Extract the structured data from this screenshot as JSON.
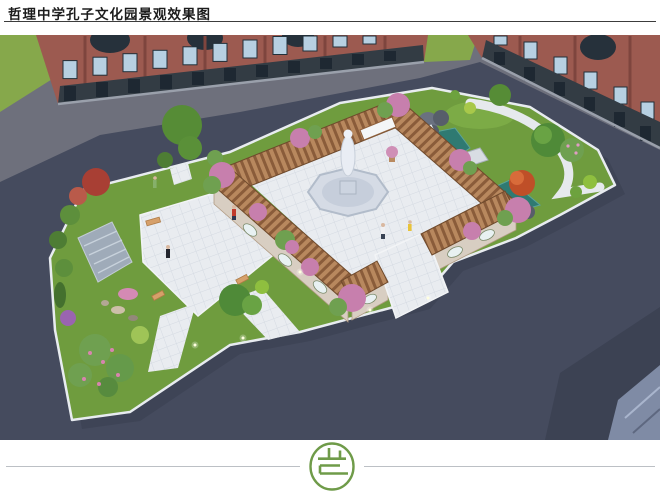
{
  "page": {
    "title": "哲理中学孔子文化园景观效果图",
    "background_color": "#ffffff",
    "title_color": "#1c1c1c",
    "title_rule_color": "#3c3c3c"
  },
  "footer": {
    "divider_color": "#bcc0c5",
    "logo": {
      "shape": "green circular seal with stylized character strokes",
      "color": "#6f9b49"
    }
  },
  "rendering": {
    "type": "3d-aerial-landscape-rendering",
    "subject": "Confucius culture garden courtyard between school buildings",
    "palette": {
      "grass_green": "#86a84b",
      "garden_lawn": "#6f9c3e",
      "road_gray": "#6e707c",
      "plaza_asphalt": "#454b5e",
      "brick_red": "#9c5a50",
      "storefront_dark": "#333c44",
      "window_glass": "#b7d0e2",
      "paving_white": "#e9ecf0",
      "pergola_wood": "#b8885e",
      "pergola_slat": "#8a5c3a",
      "wisteria_pink": "#c77fad",
      "pond_teal": "#2f7a72",
      "statue_white": "#e9edf4",
      "maple_red": "#a83f34",
      "bench_tan": "#d6a06a"
    },
    "features": [
      "red-brick school buildings with arched windows",
      "confucius statue on octagonal railed plinth plaza",
      "square pergola corridor ring with pink flowering vines",
      "culture wall panels with oval plaques",
      "south entrance walkway through pergola gap",
      "east pond with stone arch bridge and rockery waterfall",
      "curved white garden path",
      "west courtyard plaza with benches and stepped water feature",
      "red maple and flowering shrubs",
      "five small visitor figures",
      "dark asphalt surrounding plaza with building shadow"
    ]
  }
}
